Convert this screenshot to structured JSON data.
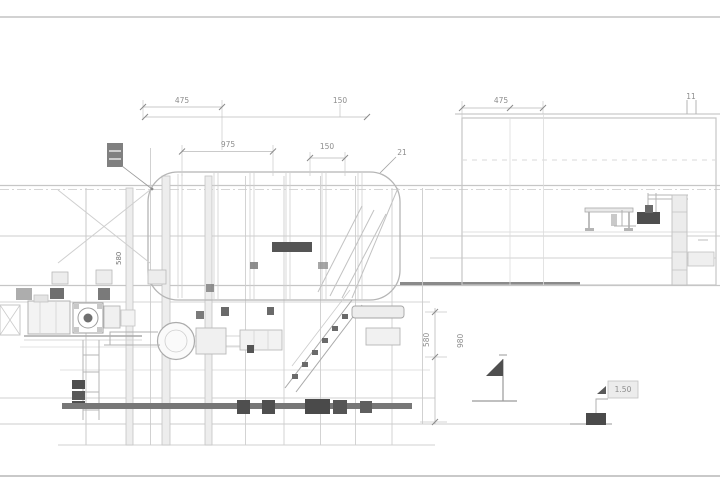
{
  "meta": {
    "type": "technical-drawing",
    "view": "machine-train-side-elevation"
  },
  "colors": {
    "background": "#ffffff",
    "line_faint": "#dcdcdc",
    "line_light": "#c6c6c6",
    "line_mid": "#9a9a9a",
    "line_dark": "#4f4f4f",
    "panel_fill": "#ededed",
    "text_gray": "#8d8d8d"
  },
  "dims": {
    "top_left": "475",
    "top_mid": "150",
    "upper_span": "975",
    "upper_small": "150",
    "callout": "21",
    "top_right": "475",
    "top_right_small": "11",
    "vert_right_a": "580",
    "vert_right_b": "980",
    "vert_left": "580",
    "elevation_note": "1.50"
  }
}
